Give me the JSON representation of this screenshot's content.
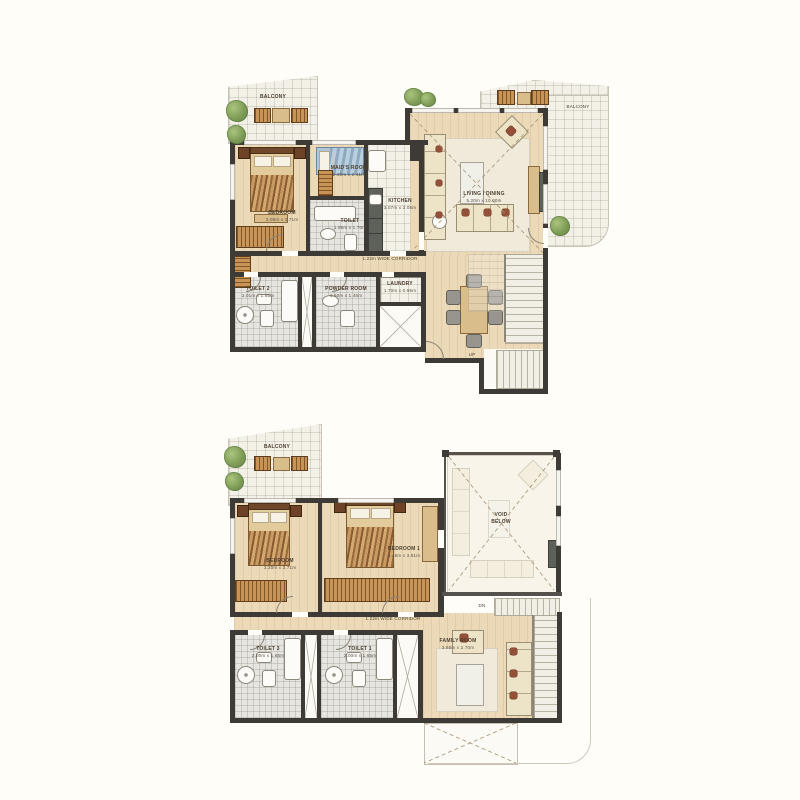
{
  "palette": {
    "background": "#FFFDF7",
    "wall": "#3E3B36",
    "wood_floor": "#EBD9B7",
    "tile_floor": "#F3F0E8",
    "bath_floor": "#E6E5E0",
    "rug": "#EFEAD9",
    "wardrobe_hatch": "#C79455",
    "tree_green": "#7E9C55",
    "accent_red": "#95503A",
    "maid_bed_blue": "#AFC6D8",
    "label_text": "#4C3F30"
  },
  "upper_plan": {
    "balcony_left": "BALCONY",
    "balcony_right": "BALCONY",
    "bedroom": {
      "name": "BEDROOM",
      "dim": "3.05m x 3.71m"
    },
    "maids_room": {
      "name": "MAID'S ROOM",
      "dim": "2.30m x 2.41m"
    },
    "toilet": {
      "name": "TOILET",
      "dim": "1.95m x 1.70m"
    },
    "kitchen": {
      "name": "KITCHEN",
      "dim": "3.07m x 2.05m"
    },
    "living_dining": {
      "name": "LIVING / DINING",
      "dim": "5.20m x 10.00m"
    },
    "corridor": "1.22m WIDE CORRIDOR",
    "toilet2": {
      "name": "TOILET 2",
      "dim": "2.01m x 1.65m"
    },
    "powder_room": {
      "name": "POWDER ROOM",
      "dim": "1.60m x 1.45m"
    },
    "laundry": {
      "name": "LAUNDRY",
      "dim": "1.70m x 0.95m"
    },
    "stairs_up": "UP"
  },
  "lower_plan": {
    "balcony": "BALCONY",
    "bedroom": {
      "name": "BEDROOM",
      "dim": "3.20m x 3.71m"
    },
    "bedroom1": {
      "name": "BEDROOM 1",
      "dim": "4.45m x 3.81m"
    },
    "void_below": "VOID BELOW",
    "corridor": "1.22m WIDE CORRIDOR",
    "toilet3": {
      "name": "TOILET 3",
      "dim": "2.00m x 1.65m"
    },
    "toilet1": {
      "name": "TOILET 1",
      "dim": "2.00m x 1.65m"
    },
    "family_room": {
      "name": "FAMILY ROOM",
      "dim": "3.65m x 2.70m"
    },
    "stairs_dn": "DN"
  }
}
